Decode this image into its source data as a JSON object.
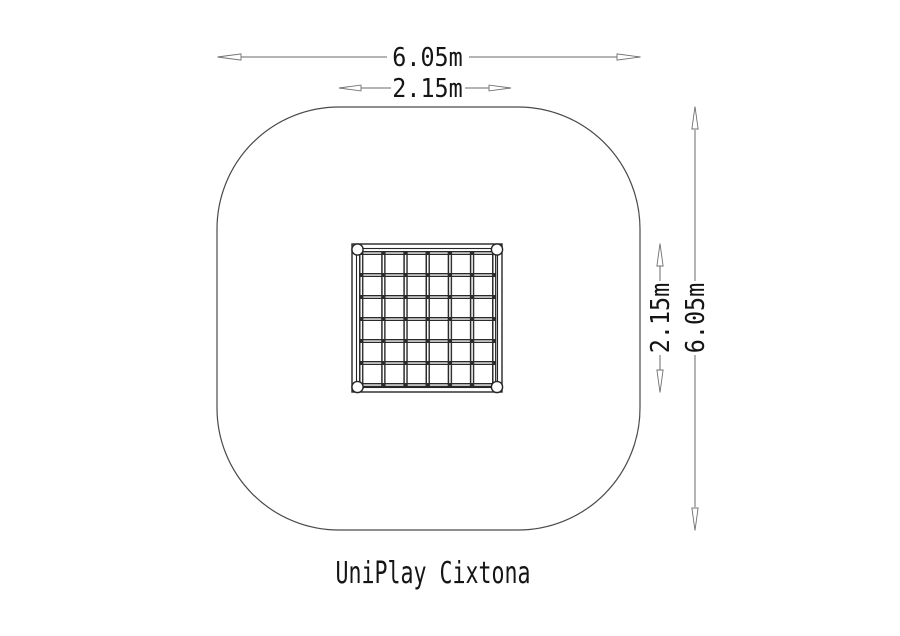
{
  "drawing": {
    "title": "UniPlay Cixtona",
    "dimensions": {
      "overall_width": "6.05m",
      "equipment_width": "2.15m",
      "equipment_height": "2.15m",
      "overall_height": "6.05m"
    },
    "colors": {
      "safety_area_outline": "#4a4a4a",
      "equipment_line": "#262626",
      "dimension_line": "#6a6a6a",
      "text": "#151515",
      "background": "#ffffff"
    }
  }
}
